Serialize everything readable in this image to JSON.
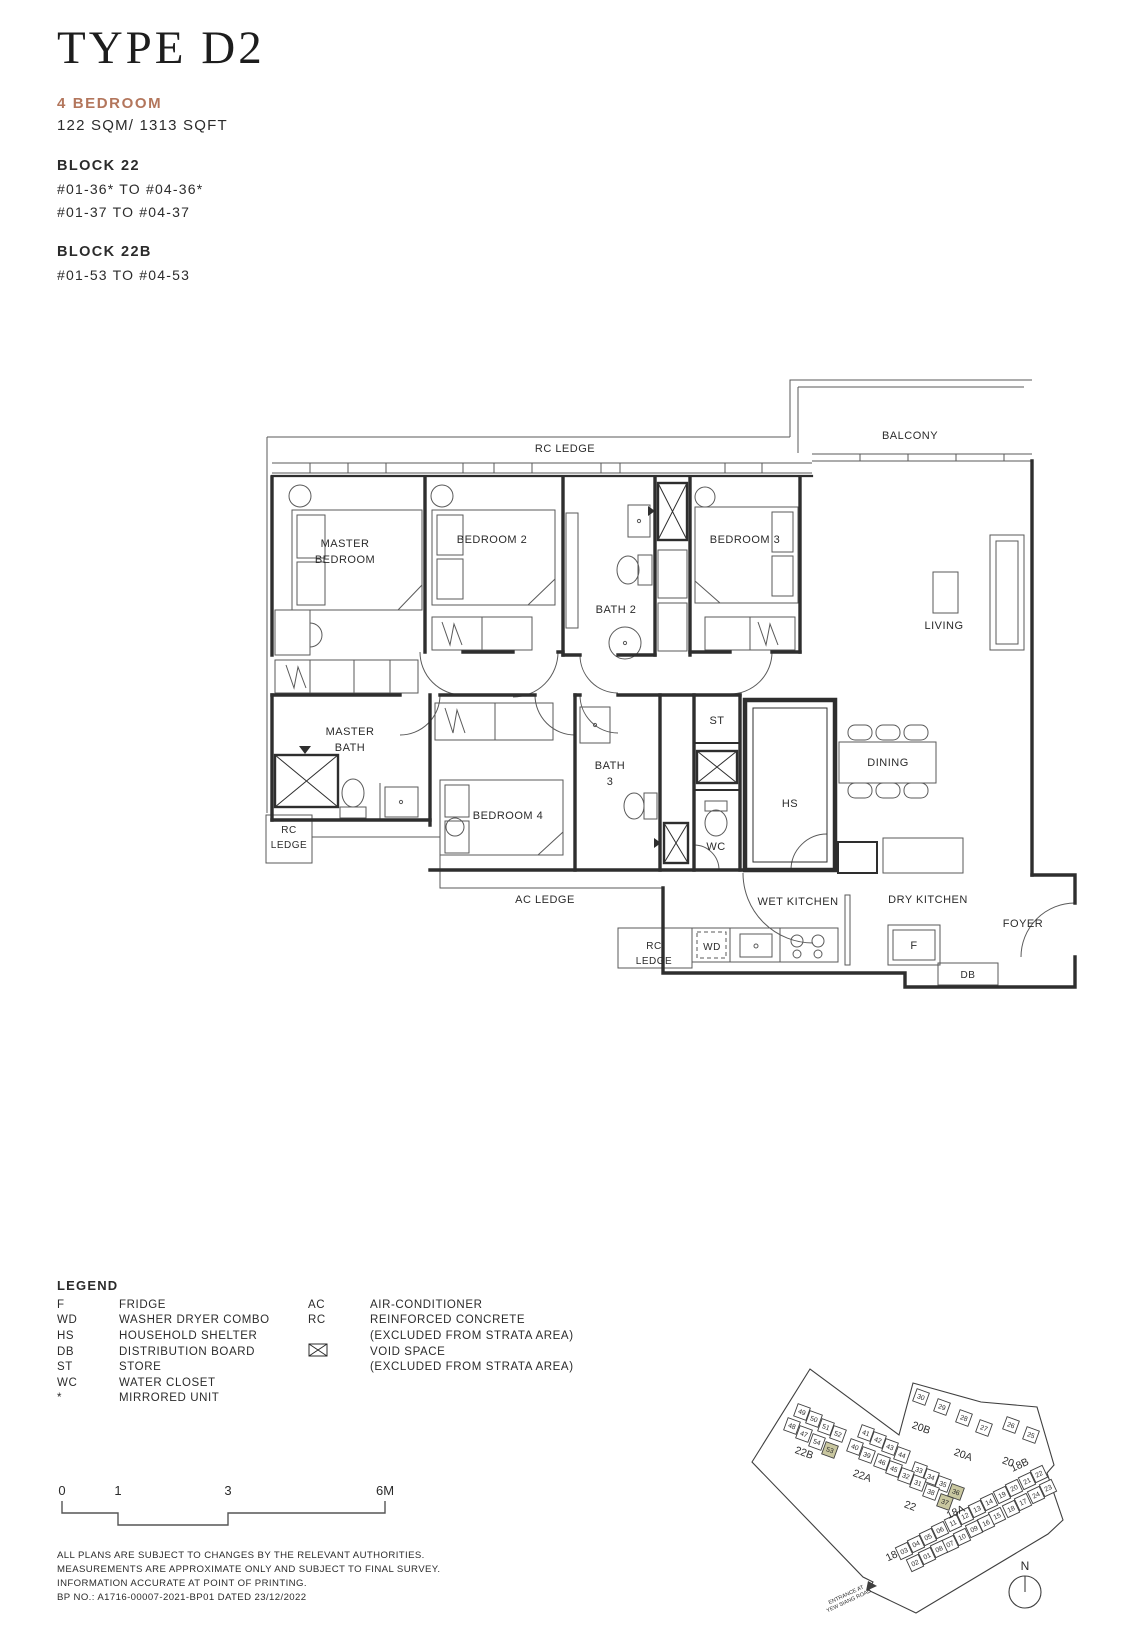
{
  "header": {
    "title": "TYPE D2",
    "bedroom_label": "4 BEDROOM",
    "area_label": "122 SQM/ 1313 SQFT",
    "accent_color": "#b3765c",
    "blocks": [
      {
        "name": "BLOCK 22",
        "units": [
          "#01-36* TO #04-36*",
          "#01-37 TO #04-37"
        ]
      },
      {
        "name": "BLOCK 22B",
        "units": [
          "#01-53 TO #04-53"
        ]
      }
    ]
  },
  "floorplan": {
    "labels": [
      {
        "lines": [
          "RC LEDGE"
        ],
        "x": 315,
        "y": 97
      },
      {
        "lines": [
          "BALCONY"
        ],
        "x": 660,
        "y": 84
      },
      {
        "lines": [
          "MASTER",
          "BEDROOM"
        ],
        "x": 95,
        "y": 192,
        "lh": 16
      },
      {
        "lines": [
          "BEDROOM 2"
        ],
        "x": 242,
        "y": 188
      },
      {
        "lines": [
          "BATH 2"
        ],
        "x": 366,
        "y": 258
      },
      {
        "lines": [
          "BEDROOM 3"
        ],
        "x": 495,
        "y": 188
      },
      {
        "lines": [
          "LIVING"
        ],
        "x": 694,
        "y": 274
      },
      {
        "lines": [
          "MASTER",
          "BATH"
        ],
        "x": 100,
        "y": 380,
        "lh": 16
      },
      {
        "lines": [
          "BEDROOM 4"
        ],
        "x": 258,
        "y": 464
      },
      {
        "lines": [
          "BATH",
          "3"
        ],
        "x": 360,
        "y": 414,
        "lh": 16
      },
      {
        "lines": [
          "ST"
        ],
        "x": 467,
        "y": 369
      },
      {
        "lines": [
          "WC"
        ],
        "x": 466,
        "y": 495
      },
      {
        "lines": [
          "HS"
        ],
        "x": 540,
        "y": 452
      },
      {
        "lines": [
          "DINING"
        ],
        "x": 638,
        "y": 411
      },
      {
        "lines": [
          "RC",
          "LEDGE"
        ],
        "x": 39,
        "y": 478,
        "lh": 15,
        "size": 10
      },
      {
        "lines": [
          "AC LEDGE"
        ],
        "x": 295,
        "y": 548
      },
      {
        "lines": [
          "RC",
          "LEDGE"
        ],
        "x": 404,
        "y": 594,
        "lh": 15,
        "size": 10
      },
      {
        "lines": [
          "WET KITCHEN"
        ],
        "x": 548,
        "y": 550
      },
      {
        "lines": [
          "DRY KITCHEN"
        ],
        "x": 678,
        "y": 548
      },
      {
        "lines": [
          "WD"
        ],
        "x": 462,
        "y": 595,
        "size": 10
      },
      {
        "lines": [
          "F"
        ],
        "x": 664,
        "y": 594
      },
      {
        "lines": [
          "FOYER"
        ],
        "x": 773,
        "y": 572
      },
      {
        "lines": [
          "DB"
        ],
        "x": 718,
        "y": 623,
        "size": 10
      }
    ]
  },
  "legend": {
    "title": "LEGEND",
    "col1": [
      {
        "abbr": "F",
        "label": "FRIDGE"
      },
      {
        "abbr": "WD",
        "label": "WASHER DRYER COMBO"
      },
      {
        "abbr": "HS",
        "label": "HOUSEHOLD SHELTER"
      },
      {
        "abbr": "DB",
        "label": "DISTRIBUTION BOARD"
      },
      {
        "abbr": "ST",
        "label": "STORE"
      },
      {
        "abbr": "WC",
        "label": "WATER CLOSET"
      },
      {
        "abbr": "*",
        "label": "MIRRORED UNIT"
      }
    ],
    "col2": [
      {
        "abbr": "AC",
        "label": "AIR-CONDITIONER"
      },
      {
        "abbr": "RC",
        "label": "REINFORCED CONCRETE"
      },
      {
        "abbr": "",
        "label": "(EXCLUDED FROM STRATA AREA)"
      },
      {
        "abbr": "",
        "icon": "void-space",
        "label": "VOID SPACE"
      },
      {
        "abbr": "",
        "label": "(EXCLUDED FROM STRATA AREA)"
      }
    ]
  },
  "scalebar": {
    "ticks": [
      "0",
      "1",
      "3",
      "6M"
    ]
  },
  "disclaimer": [
    "ALL PLANS ARE SUBJECT TO CHANGES BY THE RELEVANT AUTHORITIES.",
    "MEASUREMENTS ARE APPROXIMATE ONLY AND SUBJECT TO FINAL SURVEY.",
    "INFORMATION ACCURATE AT POINT OF PRINTING.",
    "BP NO.: A1716-00007-2021-BP01 DATED 23/12/2022"
  ],
  "sitemap": {
    "highlight_color": "#c9c7a0",
    "highlighted_units": [
      "53",
      "36",
      "37"
    ],
    "entrance_label": [
      "ENTRANCE AT",
      "YEW SIANG ROAD"
    ],
    "compass_label": "N",
    "block_labels": [
      {
        "t": "22B",
        "x": 103,
        "y": 166,
        "r": 20
      },
      {
        "t": "22A",
        "x": 161,
        "y": 189,
        "r": 20
      },
      {
        "t": "22",
        "x": 209,
        "y": 219,
        "r": 20
      },
      {
        "t": "20B",
        "x": 220,
        "y": 141,
        "r": 20
      },
      {
        "t": "20A",
        "x": 262,
        "y": 168,
        "r": 20
      },
      {
        "t": "20",
        "x": 307,
        "y": 175,
        "r": 20
      },
      {
        "t": "18B",
        "x": 321,
        "y": 178,
        "r": -25
      },
      {
        "t": "18A",
        "x": 257,
        "y": 225,
        "r": -25
      },
      {
        "t": "18",
        "x": 193,
        "y": 269,
        "r": -25
      }
    ],
    "units": [
      {
        "n": "49",
        "x": 102,
        "y": 122,
        "r": 20
      },
      {
        "n": "50",
        "x": 114,
        "y": 129,
        "r": 20
      },
      {
        "n": "51",
        "x": 126,
        "y": 137,
        "r": 20
      },
      {
        "n": "52",
        "x": 138,
        "y": 144,
        "r": 20
      },
      {
        "n": "48",
        "x": 92,
        "y": 136,
        "r": 20
      },
      {
        "n": "47",
        "x": 104,
        "y": 144,
        "r": 20
      },
      {
        "n": "54",
        "x": 117,
        "y": 152,
        "r": 20
      },
      {
        "n": "53",
        "x": 130,
        "y": 160,
        "r": 20,
        "h": true
      },
      {
        "n": "30",
        "x": 221,
        "y": 107,
        "r": 20
      },
      {
        "n": "29",
        "x": 242,
        "y": 117,
        "r": 20
      },
      {
        "n": "28",
        "x": 264,
        "y": 128,
        "r": 20
      },
      {
        "n": "27",
        "x": 284,
        "y": 138,
        "r": 20
      },
      {
        "n": "26",
        "x": 311,
        "y": 135,
        "r": 20
      },
      {
        "n": "25",
        "x": 331,
        "y": 145,
        "r": 20
      },
      {
        "n": "41",
        "x": 166,
        "y": 143,
        "r": 20
      },
      {
        "n": "42",
        "x": 178,
        "y": 150,
        "r": 20
      },
      {
        "n": "43",
        "x": 190,
        "y": 157,
        "r": 20
      },
      {
        "n": "44",
        "x": 202,
        "y": 165,
        "r": 20
      },
      {
        "n": "33",
        "x": 219,
        "y": 180,
        "r": 20
      },
      {
        "n": "34",
        "x": 231,
        "y": 187,
        "r": 20
      },
      {
        "n": "35",
        "x": 243,
        "y": 194,
        "r": 20
      },
      {
        "n": "36",
        "x": 256,
        "y": 202,
        "r": 20,
        "h": true
      },
      {
        "n": "40",
        "x": 155,
        "y": 157,
        "r": 20
      },
      {
        "n": "39",
        "x": 167,
        "y": 165,
        "r": 20
      },
      {
        "n": "46",
        "x": 182,
        "y": 172,
        "r": 20
      },
      {
        "n": "45",
        "x": 194,
        "y": 179,
        "r": 20
      },
      {
        "n": "32",
        "x": 206,
        "y": 186,
        "r": 20
      },
      {
        "n": "31",
        "x": 218,
        "y": 193,
        "r": 20
      },
      {
        "n": "38",
        "x": 231,
        "y": 202,
        "r": 20
      },
      {
        "n": "37",
        "x": 245,
        "y": 212,
        "r": 20,
        "h": true
      },
      {
        "n": "22",
        "x": 339,
        "y": 184,
        "r": -25
      },
      {
        "n": "21",
        "x": 327,
        "y": 191,
        "r": -25
      },
      {
        "n": "20",
        "x": 314,
        "y": 198,
        "r": -25
      },
      {
        "n": "19",
        "x": 302,
        "y": 205,
        "r": -25
      },
      {
        "n": "14",
        "x": 289,
        "y": 212,
        "r": -25
      },
      {
        "n": "13",
        "x": 277,
        "y": 219,
        "r": -25
      },
      {
        "n": "12",
        "x": 265,
        "y": 226,
        "r": -25
      },
      {
        "n": "11",
        "x": 253,
        "y": 233,
        "r": -25
      },
      {
        "n": "06",
        "x": 240,
        "y": 240,
        "r": -25
      },
      {
        "n": "05",
        "x": 228,
        "y": 247,
        "r": -25
      },
      {
        "n": "04",
        "x": 216,
        "y": 254,
        "r": -25
      },
      {
        "n": "03",
        "x": 204,
        "y": 261,
        "r": -25
      },
      {
        "n": "23",
        "x": 348,
        "y": 198,
        "r": -25
      },
      {
        "n": "24",
        "x": 336,
        "y": 205,
        "r": -25
      },
      {
        "n": "17",
        "x": 323,
        "y": 212,
        "r": -25
      },
      {
        "n": "18",
        "x": 311,
        "y": 219,
        "r": -25
      },
      {
        "n": "15",
        "x": 297,
        "y": 226,
        "r": -25
      },
      {
        "n": "16",
        "x": 286,
        "y": 233,
        "r": -25
      },
      {
        "n": "09",
        "x": 274,
        "y": 239,
        "r": -25
      },
      {
        "n": "10",
        "x": 262,
        "y": 247,
        "r": -25
      },
      {
        "n": "07",
        "x": 250,
        "y": 254,
        "r": -25
      },
      {
        "n": "08",
        "x": 239,
        "y": 259,
        "r": -25
      },
      {
        "n": "01",
        "x": 227,
        "y": 266,
        "r": -25
      },
      {
        "n": "02",
        "x": 215,
        "y": 273,
        "r": -25
      }
    ]
  }
}
